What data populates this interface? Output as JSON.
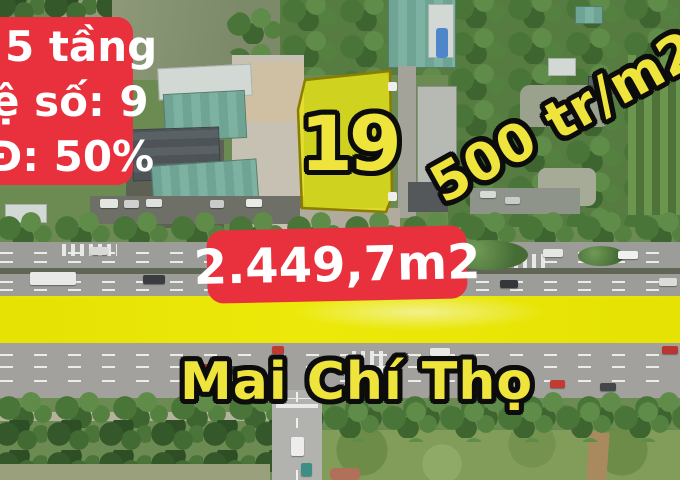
{
  "colors": {
    "overlay_red": "#e8313d",
    "overlay_yellow": "#efe43c",
    "band_yellow": "#ebe600",
    "plot_fill": "#e9e412",
    "text_white": "#ffffff",
    "outline_black": "#0c0c0c"
  },
  "overlays": {
    "info_box": {
      "lines": [
        "5 tầng",
        "ệ số: 9",
        "Đ: 50%"
      ]
    },
    "plot_number": {
      "text": "19"
    },
    "price_label": {
      "text": "500 tr/m2"
    },
    "area_banner": {
      "text": "2.449,7m2"
    },
    "street_label": {
      "text": "Mai Chí Thọ"
    }
  }
}
